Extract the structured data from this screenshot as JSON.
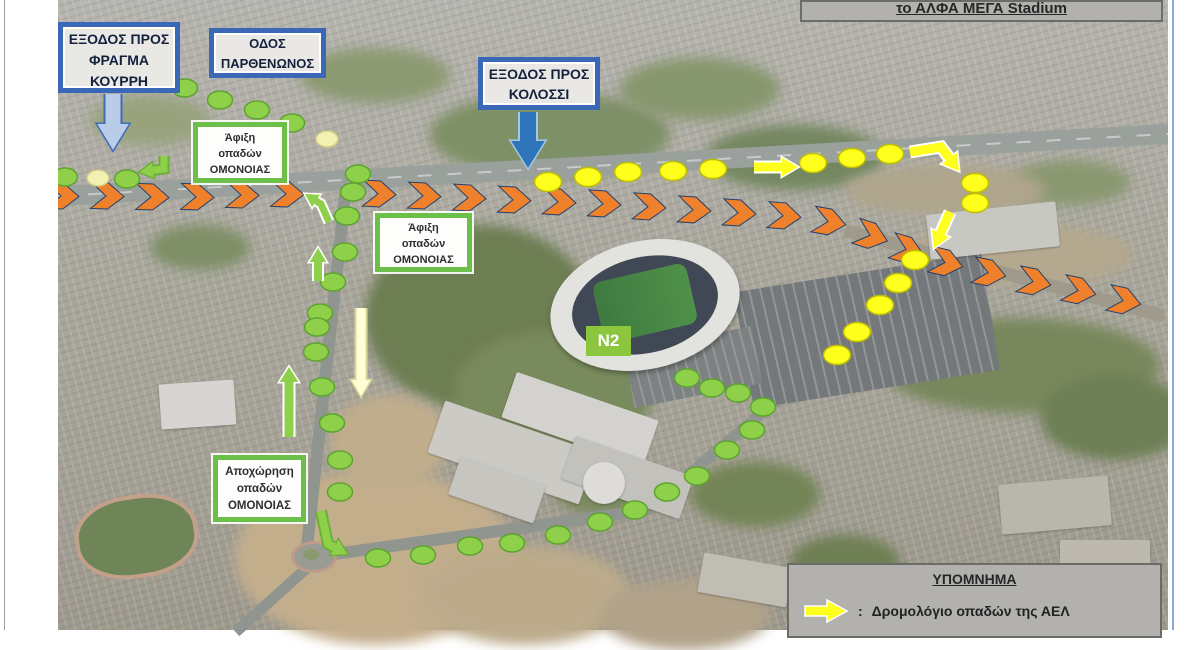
{
  "title_box": {
    "text": "το ΑΛΦΑ ΜΕΓΑ Stadium"
  },
  "signs": {
    "fragma": {
      "lines": [
        "ΕΞΟΔΟΣ ΠΡΟΣ",
        "ΦΡΑΓΜΑ",
        "ΚΟΥΡΡΗ"
      ]
    },
    "parthenonos": {
      "lines": [
        "ΟΔΟΣ",
        "ΠΑΡΘΕΝΩΝΟΣ"
      ]
    },
    "kolossi": {
      "lines": [
        "ΕΞΟΔΟΣ ΠΡΟΣ",
        "ΚΟΛΟΣΣΙ"
      ]
    },
    "afixi1": {
      "lines": [
        "Άφιξη",
        "οπαδών",
        "ΟΜΟΝΟΙΑΣ"
      ]
    },
    "afixi2": {
      "lines": [
        "Άφιξη",
        "οπαδών",
        "ΟΜΟΝΟΙΑΣ"
      ]
    },
    "apoxorisi": {
      "lines": [
        "Αποχώρηση",
        "οπαδών",
        "ΟΜΟΝΟΙΑΣ"
      ]
    },
    "n2": {
      "text": "N2"
    }
  },
  "legend": {
    "title": "ΥΠΟΜΝΗΜΑ",
    "items": [
      {
        "marker": "yellow-arrow",
        "separator": ":",
        "label": "Δρομολόγιο οπαδών της ΑΕΛ"
      }
    ]
  },
  "colors": {
    "omonoia_green": "#8ed04a",
    "omonoia_green_edge": "#5da32f",
    "ael_yellow": "#ffff1e",
    "ael_yellow_edge": "#bdbd05",
    "orange": "#f0812c",
    "orange_edge": "#23406e",
    "pale_dot": "#f3f0b4",
    "pale_dot_edge": "#cfcc84",
    "sign_blue": "#3a67b6",
    "arrow_blue": "#2e74b8",
    "arrow_lightblue": "#b9cce8",
    "legend_gray": "#b3b1ae",
    "n2_green": "#8cc63e"
  },
  "routes": {
    "omonoia_green_dots": [
      [
        185,
        88
      ],
      [
        220,
        100
      ],
      [
        257,
        110
      ],
      [
        292,
        123
      ],
      [
        358,
        174
      ],
      [
        353,
        192
      ],
      [
        347,
        216
      ],
      [
        345,
        252
      ],
      [
        333,
        282
      ],
      [
        320,
        313
      ],
      [
        317,
        327
      ],
      [
        316,
        352
      ],
      [
        322,
        387
      ],
      [
        332,
        423
      ],
      [
        340,
        460
      ],
      [
        340,
        492
      ],
      [
        378,
        558
      ],
      [
        423,
        555
      ],
      [
        470,
        546
      ],
      [
        512,
        543
      ],
      [
        558,
        535
      ],
      [
        600,
        522
      ],
      [
        635,
        510
      ],
      [
        667,
        492
      ],
      [
        697,
        476
      ],
      [
        727,
        450
      ],
      [
        752,
        430
      ],
      [
        763,
        407
      ],
      [
        738,
        393
      ],
      [
        712,
        388
      ],
      [
        687,
        378
      ],
      [
        65,
        177
      ],
      [
        127,
        179
      ]
    ],
    "pale_dots": [
      [
        98,
        178
      ],
      [
        327,
        139
      ]
    ],
    "ael_yellow_dots": [
      [
        548,
        182
      ],
      [
        588,
        177
      ],
      [
        628,
        172
      ],
      [
        673,
        171
      ],
      [
        713,
        169
      ],
      [
        813,
        163
      ],
      [
        852,
        158
      ],
      [
        890,
        154
      ],
      [
        975,
        183
      ],
      [
        975,
        203
      ],
      [
        915,
        260
      ],
      [
        898,
        283
      ],
      [
        880,
        305
      ],
      [
        857,
        332
      ],
      [
        837,
        355
      ]
    ],
    "orange_chevrons": [
      [
        63,
        196,
        2
      ],
      [
        108,
        196,
        2
      ],
      [
        153,
        197,
        2
      ],
      [
        198,
        197,
        2
      ],
      [
        243,
        195,
        2
      ],
      [
        288,
        194,
        2
      ],
      [
        380,
        194,
        3
      ],
      [
        425,
        196,
        3
      ],
      [
        470,
        198,
        3
      ],
      [
        515,
        200,
        3
      ],
      [
        560,
        202,
        4
      ],
      [
        605,
        204,
        4
      ],
      [
        650,
        207,
        4
      ],
      [
        695,
        210,
        4
      ],
      [
        740,
        213,
        4
      ],
      [
        785,
        216,
        5
      ],
      [
        830,
        222,
        10
      ],
      [
        872,
        236,
        18
      ],
      [
        908,
        250,
        16
      ],
      [
        947,
        263,
        13
      ],
      [
        990,
        273,
        11
      ],
      [
        1035,
        282,
        11
      ],
      [
        1080,
        291,
        12
      ],
      [
        1125,
        301,
        12
      ]
    ],
    "arrows": [
      {
        "name": "fragma-direction-arrow",
        "color": "#b9cce8",
        "outline": "#3f6cb5",
        "width": 15,
        "head": 26,
        "points": [
          [
            113,
            94
          ],
          [
            113,
            150
          ]
        ]
      },
      {
        "name": "kolossi-direction-arrow",
        "color": "#2e74b8",
        "outline": "#a9c7e8",
        "width": 16,
        "head": 27,
        "points": [
          [
            528,
            112
          ],
          [
            528,
            168
          ]
        ]
      },
      {
        "name": "ael-highway-east-arrow",
        "color": "#ffff1e",
        "outline": "#ffffff",
        "width": 9,
        "head": 16,
        "points": [
          [
            754,
            167
          ],
          [
            798,
            167
          ]
        ]
      },
      {
        "name": "ael-exit-elbow-arrow",
        "color": "#ffff1e",
        "outline": "#ffffff",
        "width": 9,
        "head": 16,
        "points": [
          [
            910,
            152
          ],
          [
            941,
            147
          ],
          [
            959,
            171
          ]
        ]
      },
      {
        "name": "ael-down-arrow",
        "color": "#ffff1e",
        "outline": "#ffffff",
        "width": 9,
        "head": 16,
        "points": [
          [
            950,
            212
          ],
          [
            934,
            248
          ]
        ]
      },
      {
        "name": "pale-route-arrow",
        "color": "#ffffd6",
        "outline": "#d8d89a",
        "width": 9,
        "head": 16,
        "points": [
          [
            361,
            308
          ],
          [
            361,
            396
          ]
        ]
      },
      {
        "name": "omonoia-west-elbow-arrow",
        "color": "#8ed04a",
        "outline": "#6cb03a",
        "width": 7,
        "head": 13,
        "points": [
          [
            164,
            156
          ],
          [
            164,
            169
          ],
          [
            140,
            172
          ]
        ]
      },
      {
        "name": "omonoia-overpass-elbow-arrow",
        "color": "#8ed04a",
        "outline": "#ffffff",
        "width": 7,
        "head": 13,
        "points": [
          [
            329,
            222
          ],
          [
            321,
            204
          ],
          [
            305,
            194
          ]
        ]
      },
      {
        "name": "omonoia-up-arrow-small",
        "color": "#8ed04a",
        "outline": "#ffffff",
        "width": 8,
        "head": 14,
        "points": [
          [
            318,
            281
          ],
          [
            318,
            248
          ]
        ]
      },
      {
        "name": "omonoia-up-arrow-long",
        "color": "#8ed04a",
        "outline": "#ffffff",
        "width": 9,
        "head": 15,
        "points": [
          [
            289,
            437
          ],
          [
            289,
            367
          ]
        ]
      },
      {
        "name": "omonoia-roundabout-elbow-arrow",
        "color": "#8ed04a",
        "outline": "#6cb03a",
        "width": 8,
        "head": 14,
        "points": [
          [
            321,
            511
          ],
          [
            328,
            544
          ],
          [
            347,
            554
          ]
        ]
      }
    ]
  }
}
